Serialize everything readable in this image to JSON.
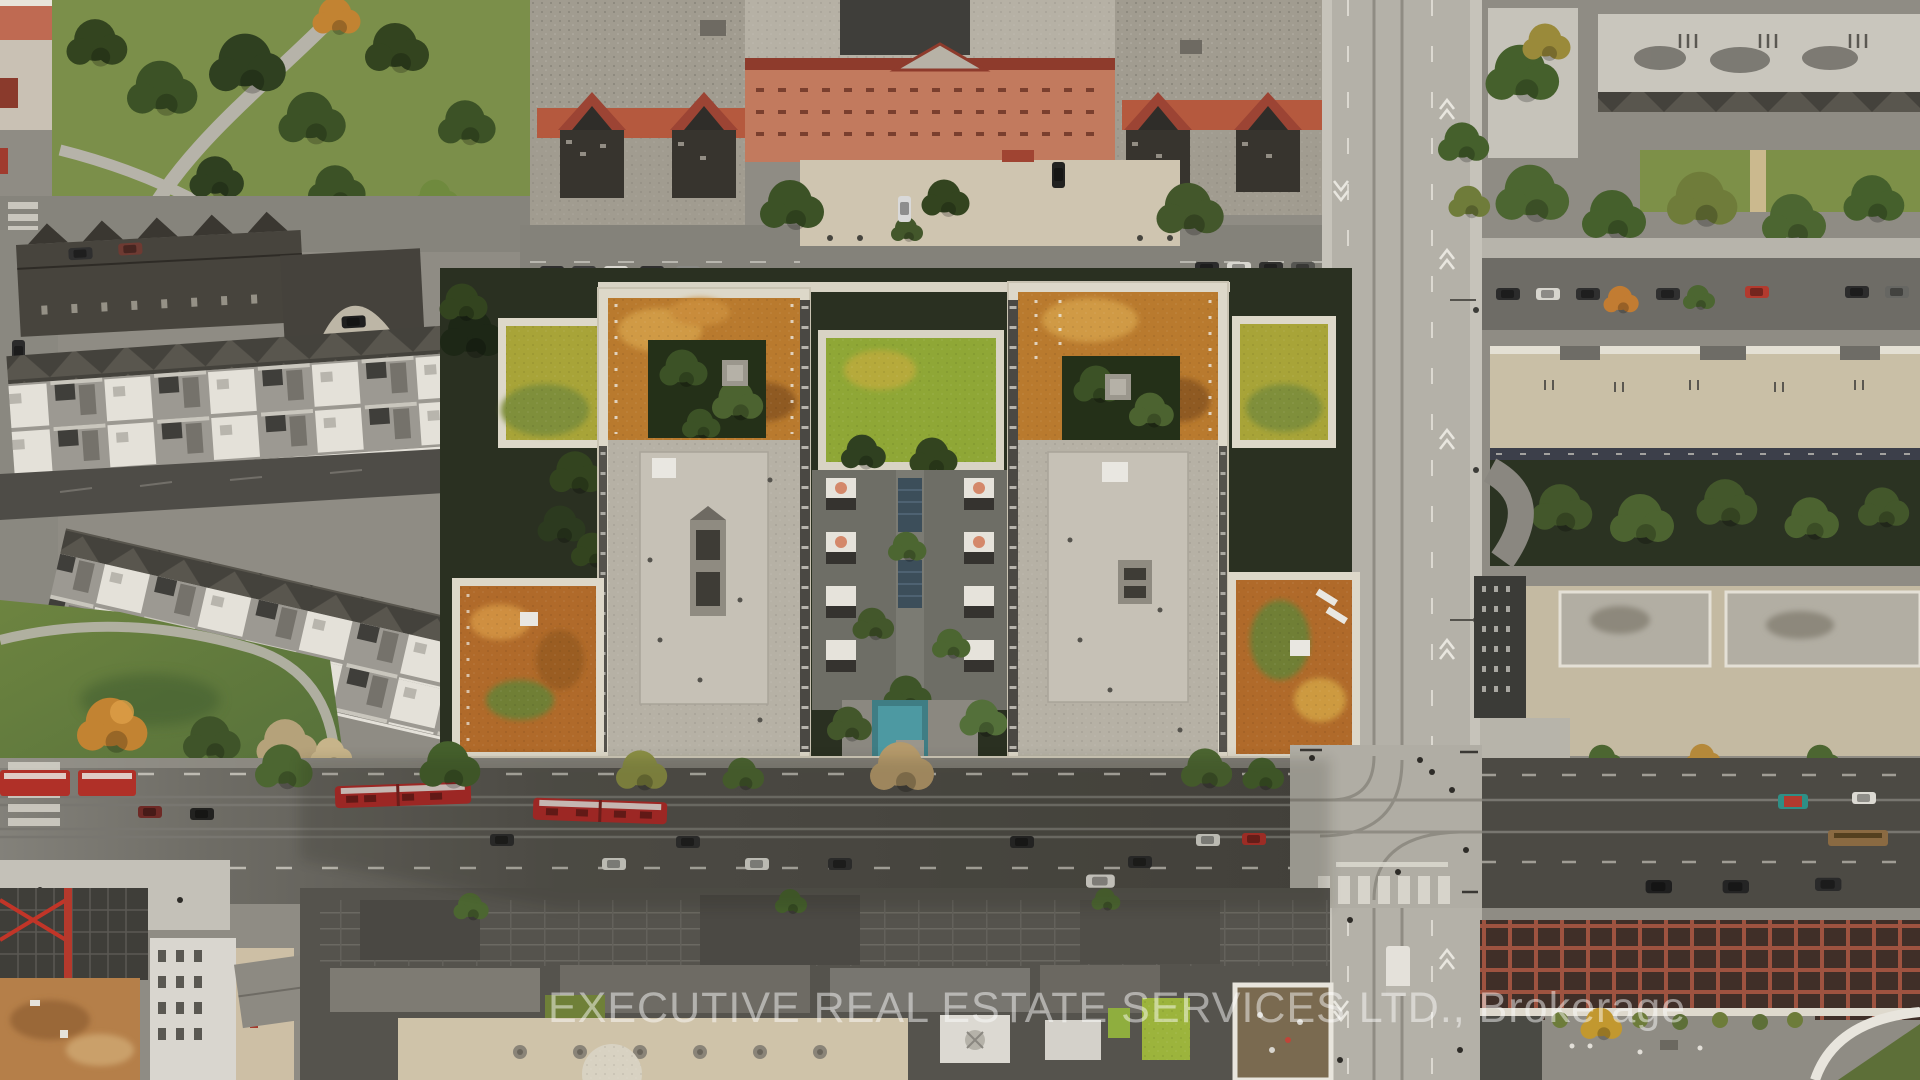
{
  "image": {
    "kind": "aerial-drone-photograph",
    "subject": "Top-down aerial view of an urban block: two mid-rise condo buildings with orange and green sedum roofs around a landscaped courtyard with an outdoor pool, flanked by a heritage red-brick apartment complex, townhouse rows, a main street with red streetcars, and a cross avenue with bike lanes",
    "season_cues": "autumn foliage",
    "lighting": "daytime, low sun, long building shadows across main street"
  },
  "watermark": {
    "text": "EXECUTIVE REAL ESTATE SERVICES LTD., Brokerage",
    "color": "#ffffff"
  },
  "palette": {
    "asphalt_shaded": "#4c4a44",
    "asphalt_sunlit": "#83817a",
    "concrete_avenue": "#b4b1a8",
    "sidewalk_light": "#c8c5bc",
    "roof_gravel": "#b6b1a5",
    "roof_gravel_light": "#c6c1b6",
    "parapet_white": "#ddd8c9",
    "sedum_orange": "#b97a2e",
    "sedum_gold": "#d09a44",
    "sedum_yellow_green": "#a8a438",
    "sedum_lime": "#8fa736",
    "sedum_rust": "#b06a2a",
    "grass_green": "#7b8f4a",
    "tree_green": "#4c6631",
    "tree_dark": "#2c3a1f",
    "tree_autumn_orange": "#c28332",
    "brick_red": "#b5593e",
    "brick_salmon": "#c27a5e",
    "roof_cap_red": "#8e3b2c",
    "streetcar_red": "#b32a28",
    "pool_teal": "#3f7d84",
    "shadow_ground": "#2a3021",
    "construction_dirt": "#b57f49",
    "crane_red": "#c13528",
    "terrace_white": "#e4e1d9"
  },
  "scene": {
    "regions": [
      {
        "id": "park-northwest",
        "label": "park with mature trees and paths"
      },
      {
        "id": "heritage-apartment-complex",
        "label": "red-brick U-shaped apartment building with gravel roof and entry court"
      },
      {
        "id": "rowhouses-northeast",
        "label": "light-roof rowhouses with gabled south edges"
      },
      {
        "id": "townhouse-rows-west",
        "label": "stacked townhouses with white rooftop terraces and laneway"
      },
      {
        "id": "condo-tower-west",
        "label": "west condo building, orange sedum roof and gravel penthouse roof"
      },
      {
        "id": "condo-tower-east",
        "label": "east condo building, orange sedum roof and gravel penthouse roof"
      },
      {
        "id": "courtyard-amenity-deck",
        "label": "interior courtyard with cabanas, trees and walkway"
      },
      {
        "id": "outdoor-pool",
        "label": "teal outdoor pool"
      },
      {
        "id": "vertical-avenue-east",
        "label": "north-south avenue with streetcar tracks and bike-lane chevrons"
      },
      {
        "id": "main-street-south",
        "label": "east-west main street with red streetcars, cars and crosswalks"
      },
      {
        "id": "intersection-southeast",
        "label": "signalized intersection with curved tracks and zebra crossing"
      },
      {
        "id": "construction-site-southwest",
        "label": "construction site with steel deck and orange excavation"
      },
      {
        "id": "commercial-rooftops-south",
        "label": "commercial strip rooftops with vents, skylights and green roof patches"
      },
      {
        "id": "brick-building-southeast",
        "label": "brick building with red roof-beam grid and rooftop terrace"
      }
    ],
    "vehicle_counts": {
      "streetcars": 3,
      "visible_cars_approx": 40
    }
  }
}
